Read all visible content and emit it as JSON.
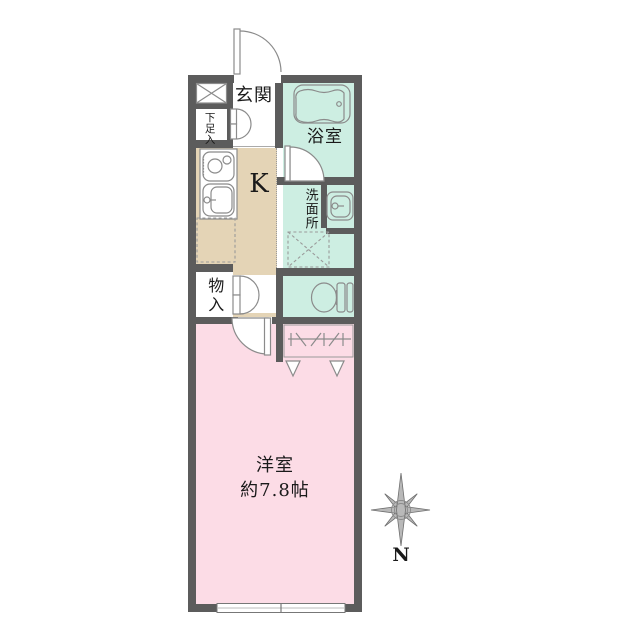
{
  "floorplan": {
    "entrance_label": "玄関",
    "shoe_storage_label": "下足入",
    "bathroom_label": "浴室",
    "kitchen_label": "K",
    "washroom_label": "洗面所",
    "storage_label": "物入",
    "main_room_label": "洋室",
    "main_room_size": "約7.8帖",
    "compass_label": "N"
  },
  "colors": {
    "wall": "#5c5c5c",
    "mint": "#cdeee2",
    "beige": "#e4d4b6",
    "pink": "#fcdce6",
    "line": "#8b8b8b",
    "text": "#1a1a1a"
  }
}
